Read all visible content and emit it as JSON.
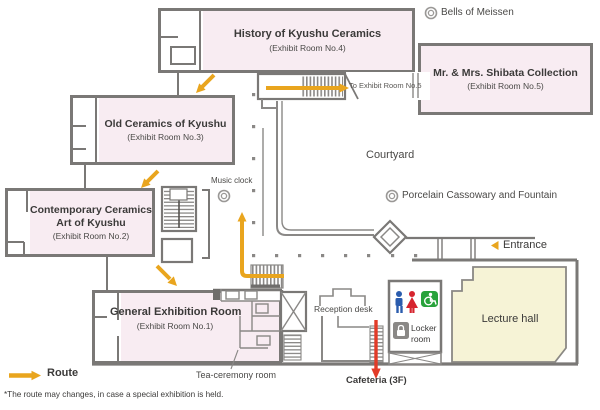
{
  "map_title": "Museum floor map",
  "colors": {
    "room_fill": "#f8ecf2",
    "wall_gray": "#7a7876",
    "route_orange": "#e9a51e",
    "cafeteria_red": "#e23b28",
    "lecture_fill": "#f6f3d6",
    "mens_blue": "#2b5cad",
    "womens_red": "#d6242e",
    "accessible_green": "#28a23b"
  },
  "rooms": {
    "history": {
      "name": "History of Kyushu Ceramics",
      "sub": "(Exhibit Room No.4)"
    },
    "shibata": {
      "name": "Mr. & Mrs. Shibata Collection",
      "sub": "(Exhibit Room No.5)"
    },
    "old": {
      "name": "Old Ceramics of Kyushu",
      "sub": "(Exhibit Room No.3)"
    },
    "contemporary": {
      "name": "Contemporary Ceramics",
      "name2": "Art of Kyushu",
      "sub": "(Exhibit Room No.2)"
    },
    "general": {
      "name": "General Exhibition Room",
      "sub": "(Exhibit Room No.1)"
    }
  },
  "places": {
    "bells": "Bells of Meissen",
    "to_room5": "To Exhibit Room No.5",
    "music_clock": "Music clock",
    "courtyard": "Courtyard",
    "porcelain": "Porcelain Cassowary and Fountain",
    "entrance": "Entrance",
    "tea_room": "Tea-ceremony room",
    "reception": "Reception desk",
    "cafeteria": "Cafeteria (3F)",
    "locker": "Locker room",
    "lecture": "Lecture hall"
  },
  "legend": {
    "route": "Route",
    "note": "*The route may changes, in case a special exhibition is held."
  }
}
